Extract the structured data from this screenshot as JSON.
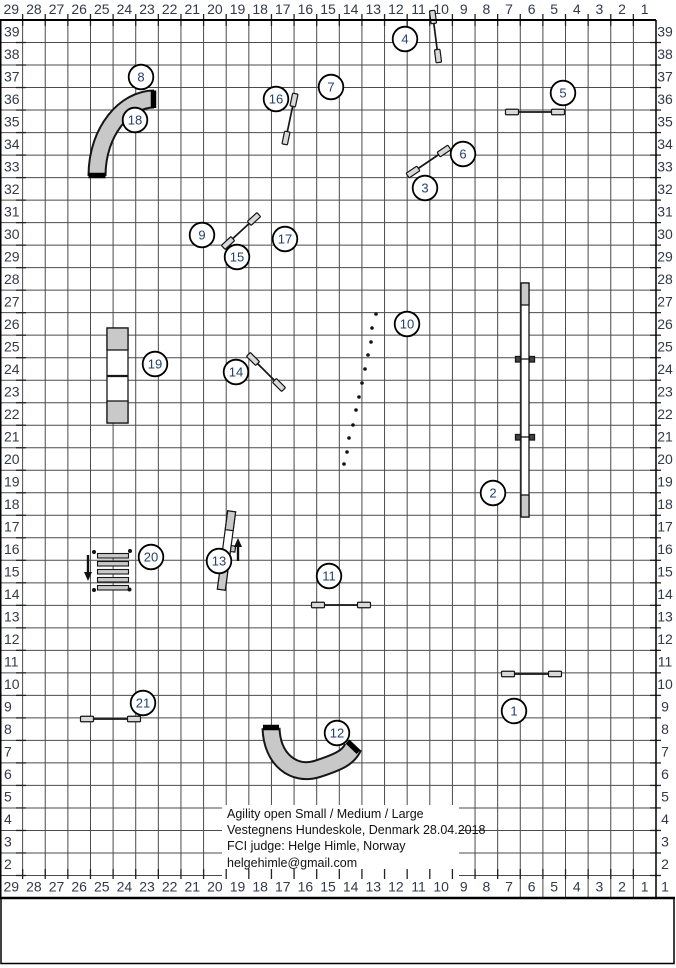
{
  "colors": {
    "grid": "#4b4b4b",
    "border": "#000000",
    "axis_text": "#323a48",
    "circle_text": "#24406e",
    "obstacle_fill": "#c9c9c9",
    "obstacle_stroke": "#161616",
    "wing_fill": "#d9d9d9",
    "tunnel_fill": "#c8c8c8"
  },
  "axes": {
    "cols_top": [
      "29",
      "28",
      "27",
      "26",
      "25",
      "24",
      "23",
      "22",
      "21",
      "20",
      "19",
      "18",
      "17",
      "16",
      "15",
      "14",
      "13",
      "12",
      "11",
      "10",
      "9",
      "8",
      "7",
      "6",
      "5",
      "4",
      "3",
      "2",
      "1"
    ],
    "cols_bottom": [
      "29",
      "28",
      "27",
      "26",
      "25",
      "24",
      "23",
      "22",
      "21",
      "20",
      "19",
      "18",
      "17",
      "16",
      "15",
      "14",
      "13",
      "12",
      "11",
      "10",
      "9",
      "8",
      "7",
      "6",
      "5",
      "4",
      "3",
      "2",
      "1"
    ],
    "rows_left": [
      "39",
      "38",
      "37",
      "36",
      "35",
      "34",
      "33",
      "32",
      "31",
      "30",
      "29",
      "28",
      "27",
      "26",
      "25",
      "24",
      "23",
      "22",
      "21",
      "20",
      "19",
      "18",
      "17",
      "16",
      "15",
      "14",
      "13",
      "12",
      "11",
      "10",
      "9",
      "8",
      "7",
      "6",
      "5",
      "4",
      "3",
      "2"
    ],
    "rows_right": [
      "39",
      "38",
      "37",
      "36",
      "35",
      "34",
      "33",
      "32",
      "31",
      "30",
      "29",
      "28",
      "27",
      "26",
      "25",
      "24",
      "23",
      "22",
      "21",
      "20",
      "19",
      "18",
      "17",
      "16",
      "15",
      "14",
      "13",
      "12",
      "11",
      "10",
      "9",
      "8",
      "7",
      "6",
      "5",
      "4",
      "3",
      "2",
      "1"
    ]
  },
  "course_info": [
    "Agility open Small / Medium / Large",
    "Vestegnens Hundeskole, Denmark 28.04.2018",
    "FCI judge: Helge Himle, Norway",
    "helgehimle@gmail.com"
  ],
  "obstacles": {
    "circles": [
      {
        "n": "1",
        "x": 514,
        "y": 711
      },
      {
        "n": "2",
        "x": 493,
        "y": 493
      },
      {
        "n": "3",
        "x": 425,
        "y": 188
      },
      {
        "n": "4",
        "x": 405,
        "y": 39
      },
      {
        "n": "5",
        "x": 563,
        "y": 93
      },
      {
        "n": "6",
        "x": 463,
        "y": 154
      },
      {
        "n": "7",
        "x": 331,
        "y": 87
      },
      {
        "n": "8",
        "x": 141,
        "y": 77
      },
      {
        "n": "9",
        "x": 202,
        "y": 235
      },
      {
        "n": "10",
        "x": 407,
        "y": 324
      },
      {
        "n": "11",
        "x": 329,
        "y": 576
      },
      {
        "n": "12",
        "x": 337,
        "y": 733
      },
      {
        "n": "13",
        "x": 219,
        "y": 561
      },
      {
        "n": "14",
        "x": 236,
        "y": 372
      },
      {
        "n": "15",
        "x": 237,
        "y": 257
      },
      {
        "n": "16",
        "x": 276,
        "y": 99
      },
      {
        "n": "17",
        "x": 285,
        "y": 239
      },
      {
        "n": "18",
        "x": 135,
        "y": 120
      },
      {
        "n": "19",
        "x": 155,
        "y": 364
      },
      {
        "n": "20",
        "x": 151,
        "y": 557
      },
      {
        "n": "21",
        "x": 143,
        "y": 703
      }
    ],
    "jumps": [
      {
        "name": "jump-4",
        "x1": 433,
        "y1": 17,
        "x2": 438,
        "y2": 56
      },
      {
        "name": "jump-5",
        "x1": 512,
        "y1": 112,
        "x2": 558,
        "y2": 112
      },
      {
        "name": "jump-3-6",
        "x1": 413,
        "y1": 172,
        "x2": 444,
        "y2": 151
      },
      {
        "name": "jump-7-16",
        "x1": 294,
        "y1": 100,
        "x2": 286,
        "y2": 138
      },
      {
        "name": "jump-9-15-17",
        "x1": 228,
        "y1": 243,
        "x2": 254,
        "y2": 219
      },
      {
        "name": "jump-14",
        "x1": 253,
        "y1": 359,
        "x2": 279,
        "y2": 385
      },
      {
        "name": "jump-11",
        "x1": 318,
        "y1": 605,
        "x2": 364,
        "y2": 605
      },
      {
        "name": "jump-1",
        "x1": 508,
        "y1": 674,
        "x2": 555,
        "y2": 674
      },
      {
        "name": "jump-21",
        "x1": 87,
        "y1": 719,
        "x2": 134,
        "y2": 719
      }
    ],
    "tunnels": [
      {
        "name": "tunnel-8-18",
        "d": "M154,99 C126,99 97,130 97,176",
        "caps": [
          [
            153.5,
            90.5,
            153.5,
            108
          ],
          [
            88.5,
            175.5,
            105.5,
            175.5
          ]
        ]
      },
      {
        "name": "tunnel-12",
        "d": "M271,728 C272,760 294,776 317,769 C339,762 349,757 353,747",
        "caps": [
          [
            263,
            727.5,
            279,
            727.5
          ],
          [
            347.5,
            741.5,
            358.5,
            752
          ]
        ]
      }
    ],
    "weave_poles": [
      [
        376,
        314
      ],
      [
        372,
        328
      ],
      [
        371,
        342
      ],
      [
        368,
        355
      ],
      [
        365,
        369
      ],
      [
        362,
        383
      ],
      [
        359,
        397
      ],
      [
        356,
        410
      ],
      [
        353,
        425
      ],
      [
        349,
        438
      ],
      [
        347,
        452
      ],
      [
        344,
        464
      ]
    ],
    "dogwalk": {
      "x": 521,
      "y": 283,
      "w": 8,
      "h": 234,
      "contact": 22,
      "junctions": [
        359,
        437
      ]
    },
    "aframe": {
      "x": 107,
      "y": 328,
      "w": 21,
      "h": 95,
      "contact": 22,
      "apex": 376
    },
    "seesaw": {
      "x": 222.5,
      "y": 511,
      "w": 8,
      "h": 79,
      "contact": 19,
      "angle": 7.5,
      "cx": 226.5,
      "cy": 550.5,
      "tab_y": 545
    },
    "longjump": {
      "x": 97.5,
      "y": 553.5,
      "w": 31,
      "slats": 5,
      "slat_h": 4.5,
      "gap": 8,
      "dots": [
        [
          94,
          552
        ],
        [
          130,
          551
        ],
        [
          94,
          590
        ],
        [
          129.5,
          589.5
        ]
      ]
    },
    "arrows": [
      {
        "name": "direction-arrow-down",
        "x": 88,
        "ytail": 555,
        "yhead": 581,
        "dir": "down"
      },
      {
        "name": "direction-arrow-up",
        "x": 238,
        "ytail": 561,
        "yhead": 538,
        "dir": "up"
      }
    ]
  }
}
